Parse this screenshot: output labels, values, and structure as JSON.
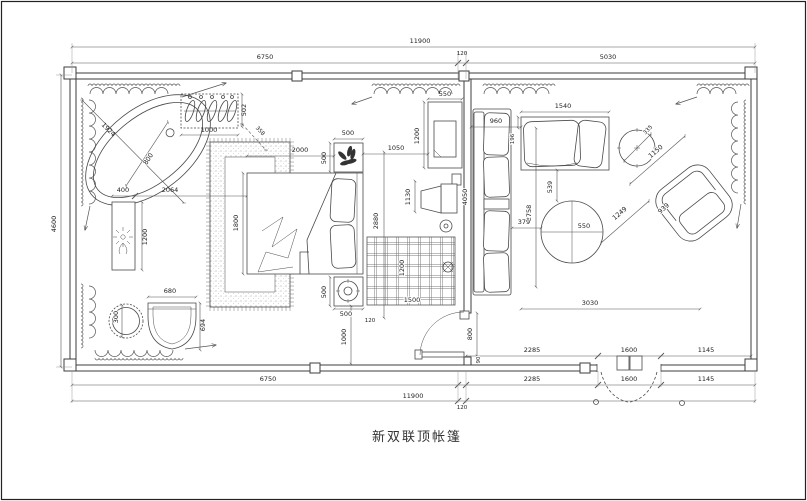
{
  "title": "新双联顶帐篷",
  "dimensions": {
    "top_total": "11900",
    "top_left": "6750",
    "top_wall": "120",
    "top_right": "5030",
    "left_height": "4600",
    "bathtub_diagonal": "1924",
    "bathtub_width": "800",
    "rack_width": "1000",
    "rack_depth": "502",
    "rack_to_rug": "358",
    "console_offset": "400",
    "console_to_bed": "2064",
    "console_length": "1200",
    "stool_diameter": "300",
    "chair_width": "680",
    "chair_depth": "694",
    "bed_width": "2000",
    "bed_length": "1800",
    "nightstand_top_width": "500",
    "nightstand_top_depth": "500",
    "nightstand_bottom_width": "500",
    "nightstand_bottom_depth": "500",
    "bed_zone_height": "2880",
    "bed_side_gap": "120",
    "bed_to_wall": "1000",
    "bed_to_cabinet": "1050",
    "cabinet_width": "550",
    "cabinet_height": "1200",
    "tv_offset": "1130",
    "grid_rug_width": "1500",
    "grid_rug_height": "1200",
    "door_width": "800",
    "door_gap": "90",
    "sofa_depth": "960",
    "sofa_gap": "196",
    "sofa_length": "4050",
    "sofa_front": "2758",
    "sofa_to_table": "379",
    "chaise_width": "1540",
    "side_table": "335",
    "table_diameter": "550",
    "chaise_to_table": "539",
    "armchair_edge": "1150",
    "table_to_armchair": "1249",
    "armchair_seat": "939",
    "living_width": "3030",
    "bottom_inner_left": "2285",
    "bottom_inner_door": "1600",
    "bottom_inner_right": "1145",
    "bottom_mid_left": "6750",
    "bottom_mid_a": "2285",
    "bottom_mid_b": "1600",
    "bottom_mid_c": "1145",
    "bottom_total": "11900",
    "bottom_wall": "120"
  }
}
